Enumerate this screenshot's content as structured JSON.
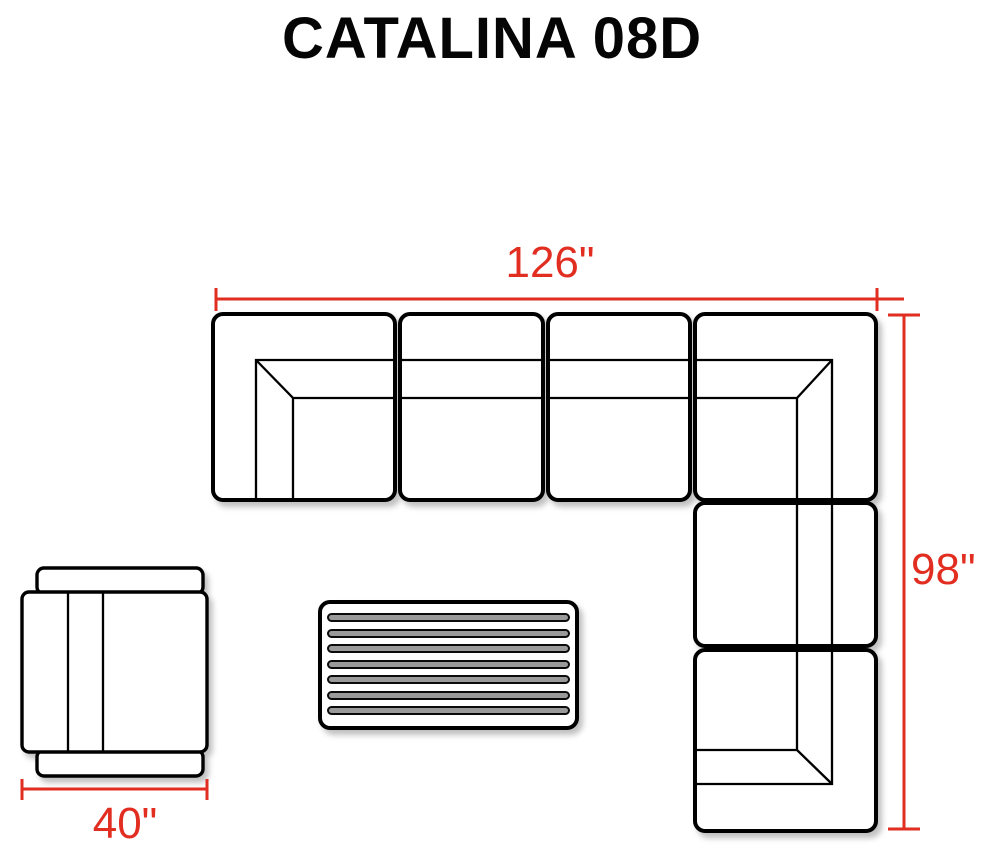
{
  "title": "CATALINA 08D",
  "colors": {
    "outline": "#000000",
    "dimension_red": "#e22d21",
    "background": "#ffffff"
  },
  "dimensions": {
    "sectional_width": {
      "label": "126\""
    },
    "sectional_depth": {
      "label": "98\""
    },
    "chair_width": {
      "label": "40\""
    }
  }
}
